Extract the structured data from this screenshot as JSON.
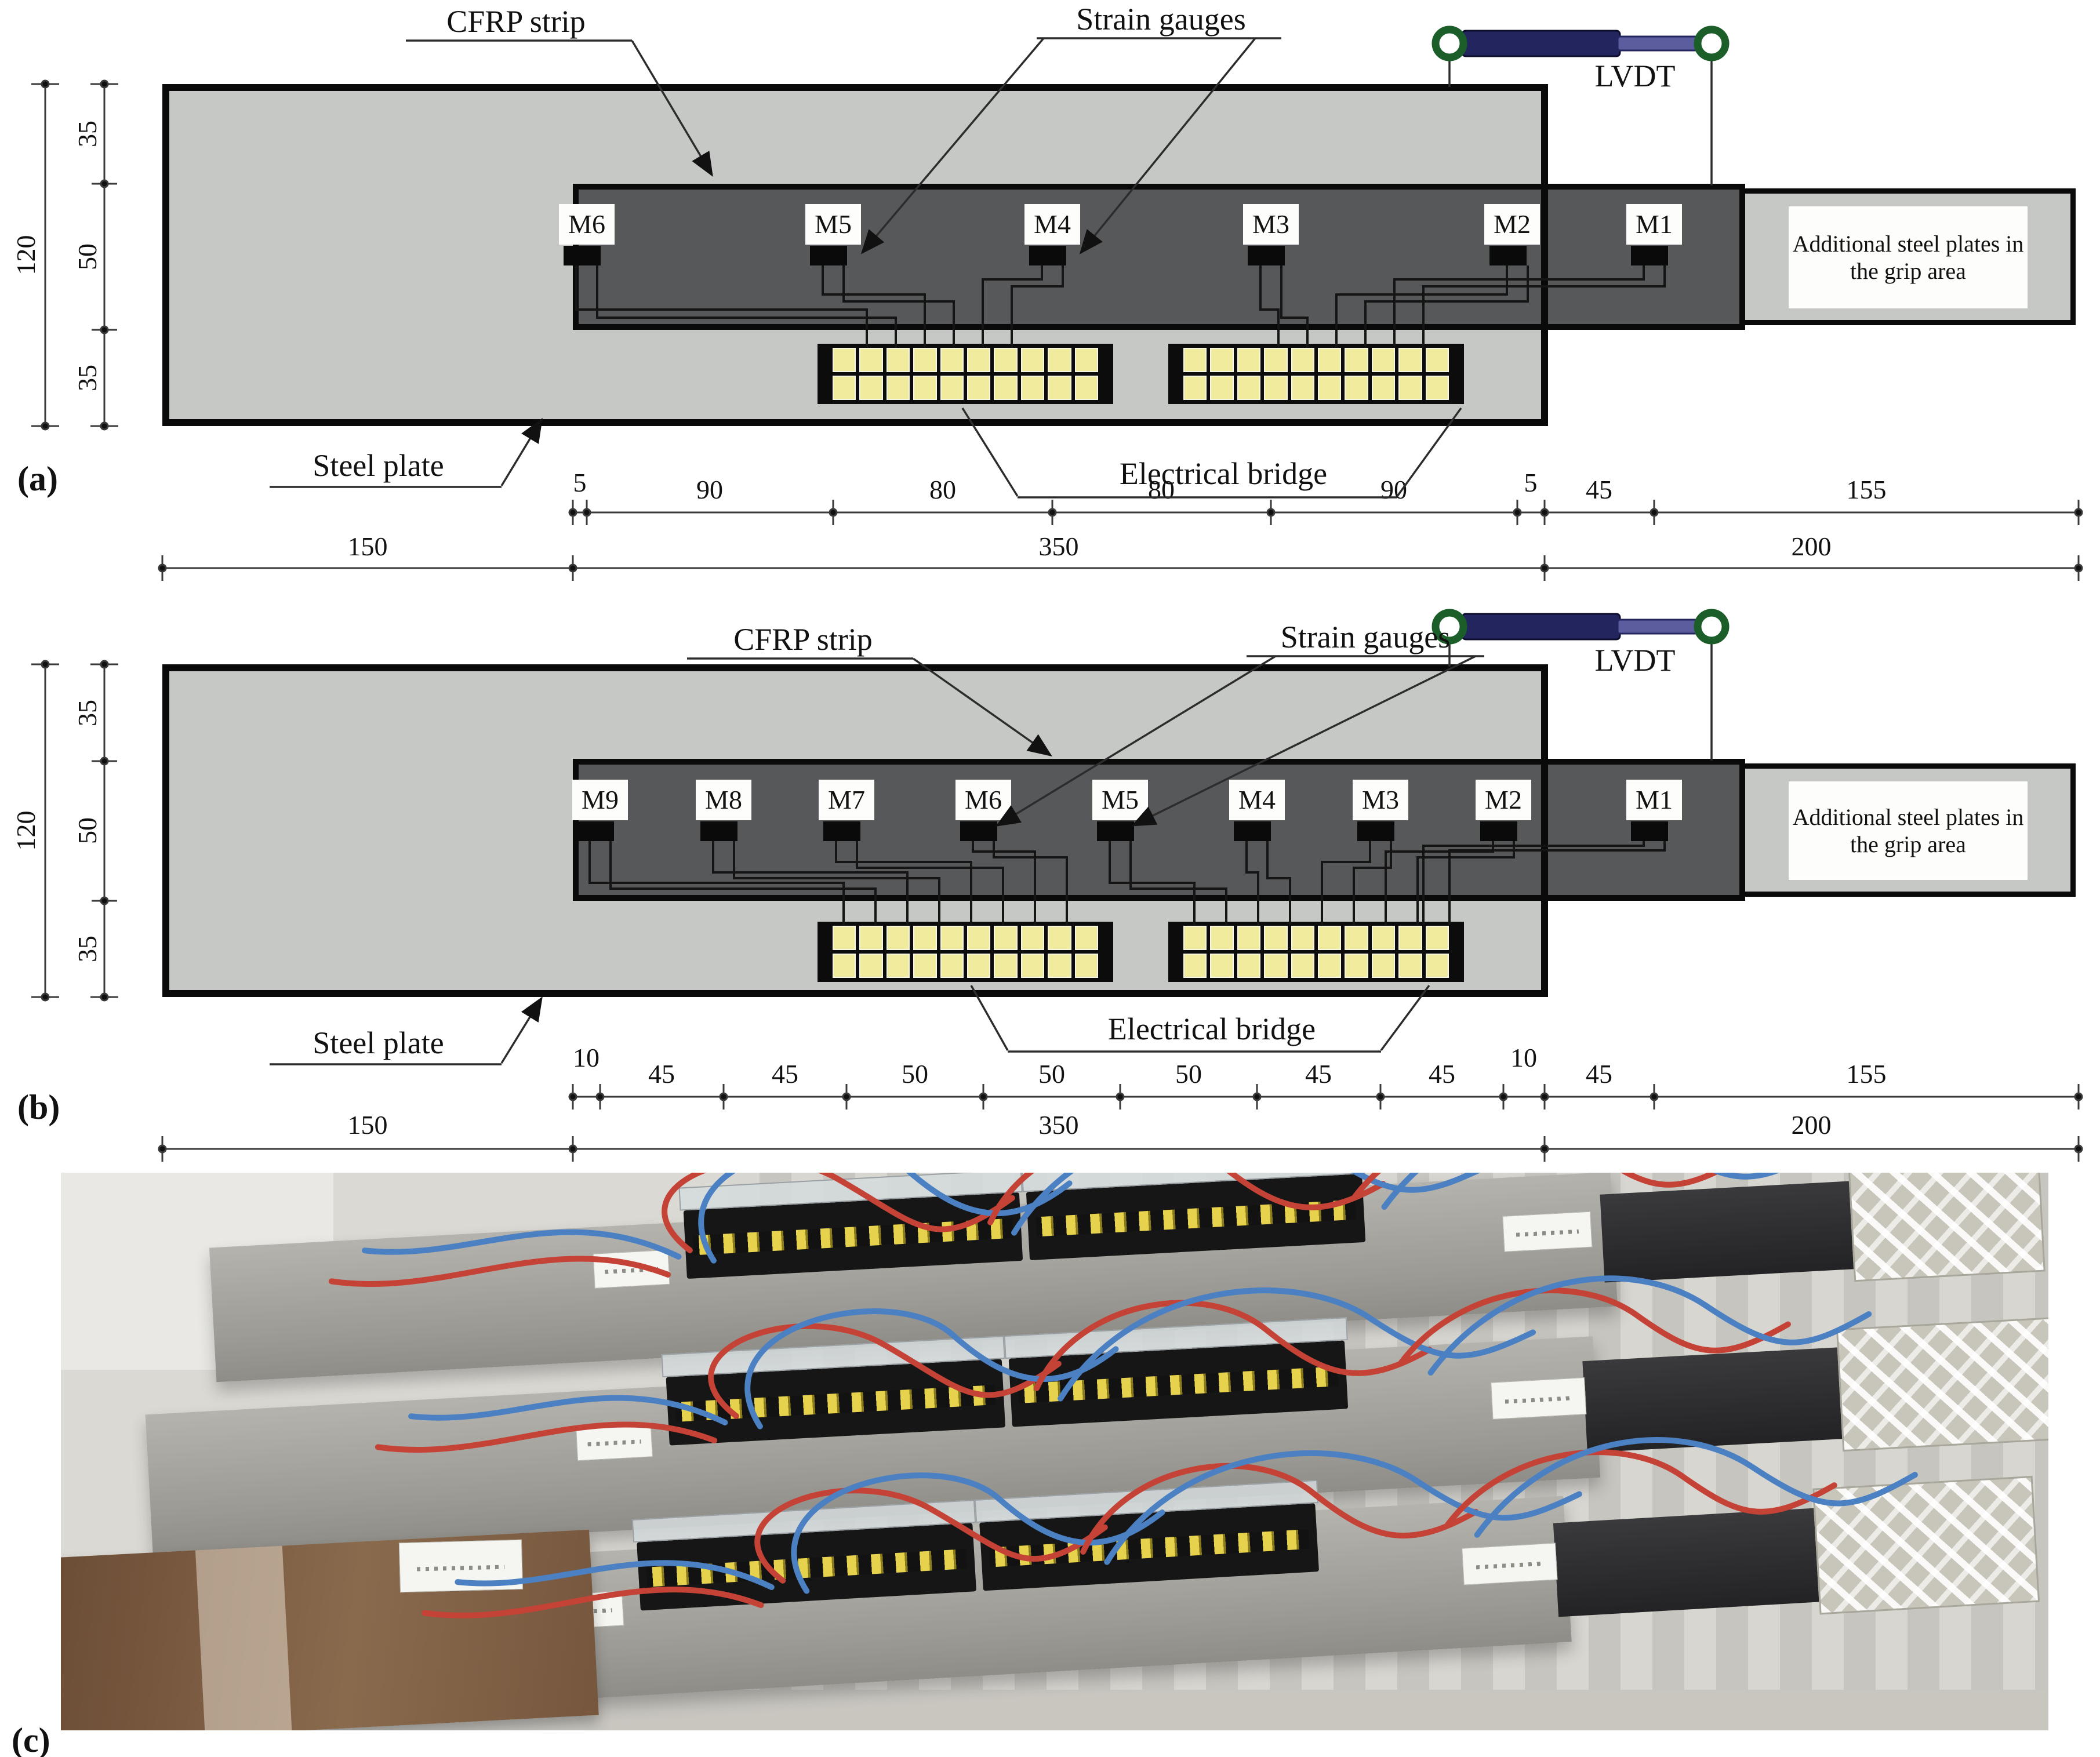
{
  "panel_a": {
    "tag": "(a)",
    "labels": {
      "cfrp_strip": "CFRP strip",
      "strain_gauges": "Strain gauges",
      "lvdt": "LVDT",
      "steel_plate": "Steel plate",
      "electrical_bridge": "Electrical bridge",
      "grip_note": "Additional steel plates in the grip area"
    },
    "height_dims": {
      "total": "120",
      "segments": [
        "35",
        "50",
        "35"
      ]
    },
    "gauges": [
      "M6",
      "M5",
      "M4",
      "M3",
      "M2",
      "M1"
    ],
    "dims_row1": [
      "5",
      "90",
      "80",
      "80",
      "90",
      "5",
      "45",
      "155"
    ],
    "dims_row2": [
      "150",
      "350",
      "200"
    ]
  },
  "panel_b": {
    "tag": "(b)",
    "labels": {
      "cfrp_strip": "CFRP strip",
      "strain_gauges": "Strain gauges",
      "lvdt": "LVDT",
      "steel_plate": "Steel plate",
      "electrical_bridge": "Electrical bridge",
      "grip_note": "Additional steel plates in the grip area"
    },
    "height_dims": {
      "total": "120",
      "segments": [
        "35",
        "50",
        "35"
      ]
    },
    "gauges": [
      "M9",
      "M8",
      "M7",
      "M6",
      "M5",
      "M4",
      "M3",
      "M2",
      "M1"
    ],
    "dims_row1": [
      "10",
      "45",
      "45",
      "50",
      "50",
      "50",
      "45",
      "45",
      "10",
      "45",
      "155"
    ],
    "dims_row2": [
      "150",
      "350",
      "200"
    ]
  },
  "panel_c": {
    "tag": "(c)"
  },
  "colors": {
    "steel_plate": "#c6c8c5",
    "cfrp_strip": "#57585a",
    "bridge_cell_yellow": "#f1eb9e",
    "lvdt_body_navy": "#23255e",
    "lvdt_ring_green": "#1b5e2a",
    "wire_red": "#c54236",
    "wire_blue": "#4b80c2"
  }
}
